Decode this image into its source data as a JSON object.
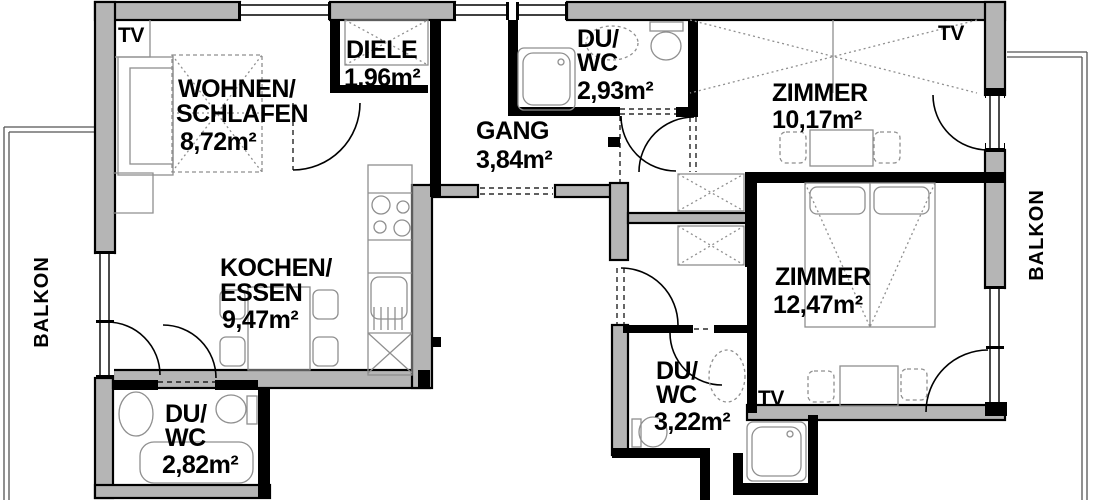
{
  "floorplan": {
    "rooms": {
      "wohnen": {
        "line1": "WOHNEN/",
        "line2": "SCHLAFEN",
        "area": "8,72m²"
      },
      "diele": {
        "line1": "DIELE",
        "area": "1,96m²"
      },
      "duwc_top": {
        "line1": "DU/",
        "line2": "WC",
        "area": "2,93m²"
      },
      "zimmer1": {
        "line1": "ZIMMER",
        "area": "10,17m²"
      },
      "gang": {
        "line1": "GANG",
        "area": "3,84m²"
      },
      "kochen": {
        "line1": "KOCHEN/",
        "line2": "ESSEN",
        "area": "9,47m²"
      },
      "zimmer2": {
        "line1": "ZIMMER",
        "area": "12,47m²"
      },
      "duwc_left": {
        "line1": "DU/",
        "line2": "WC",
        "area": "2,82m²"
      },
      "duwc_right": {
        "line1": "DU/",
        "line2": "WC",
        "area": "3,22m²"
      },
      "balkon_left": {
        "label": "BALKON"
      },
      "balkon_right": {
        "label": "BALKON"
      }
    },
    "markers": {
      "tv_wohnen": "TV",
      "tv_zimmer1": "TV",
      "tv_zimmer2": "TV"
    },
    "colors": {
      "wall_fill": "#b5b5b5",
      "wall_stroke": "#000000",
      "furniture": "#8f8f8f",
      "background": "#ffffff"
    }
  }
}
